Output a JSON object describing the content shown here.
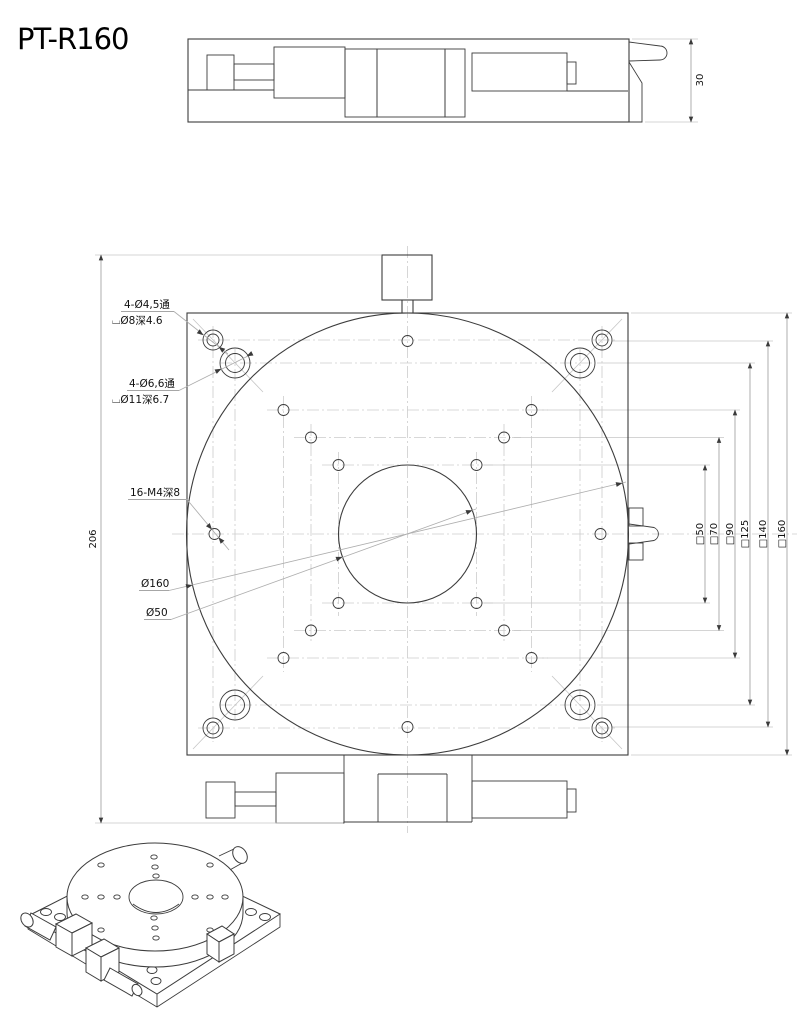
{
  "title": "PT-R160",
  "colors": {
    "line": "#3c3c3c",
    "centerline": "#cccccc",
    "dim_line": "#a6a6a6",
    "text": "#111111",
    "background": "#ffffff"
  },
  "side_view": {
    "thickness_dim": "30"
  },
  "plan_view": {
    "height_dim": "206",
    "square_dims": [
      "□50",
      "□70",
      "□90",
      "□125",
      "□140",
      "□160"
    ],
    "annotations": {
      "corner_hole_small_1": "4-Ø4,5通",
      "corner_hole_small_2": "⌴Ø8深4.6",
      "corner_hole_large_1": "4-Ø6,6通",
      "corner_hole_large_2": "⌴Ø11深6.7",
      "tapped_holes": "16-M4深8",
      "table_diameter": "Ø160",
      "center_bore": "Ø50"
    }
  }
}
